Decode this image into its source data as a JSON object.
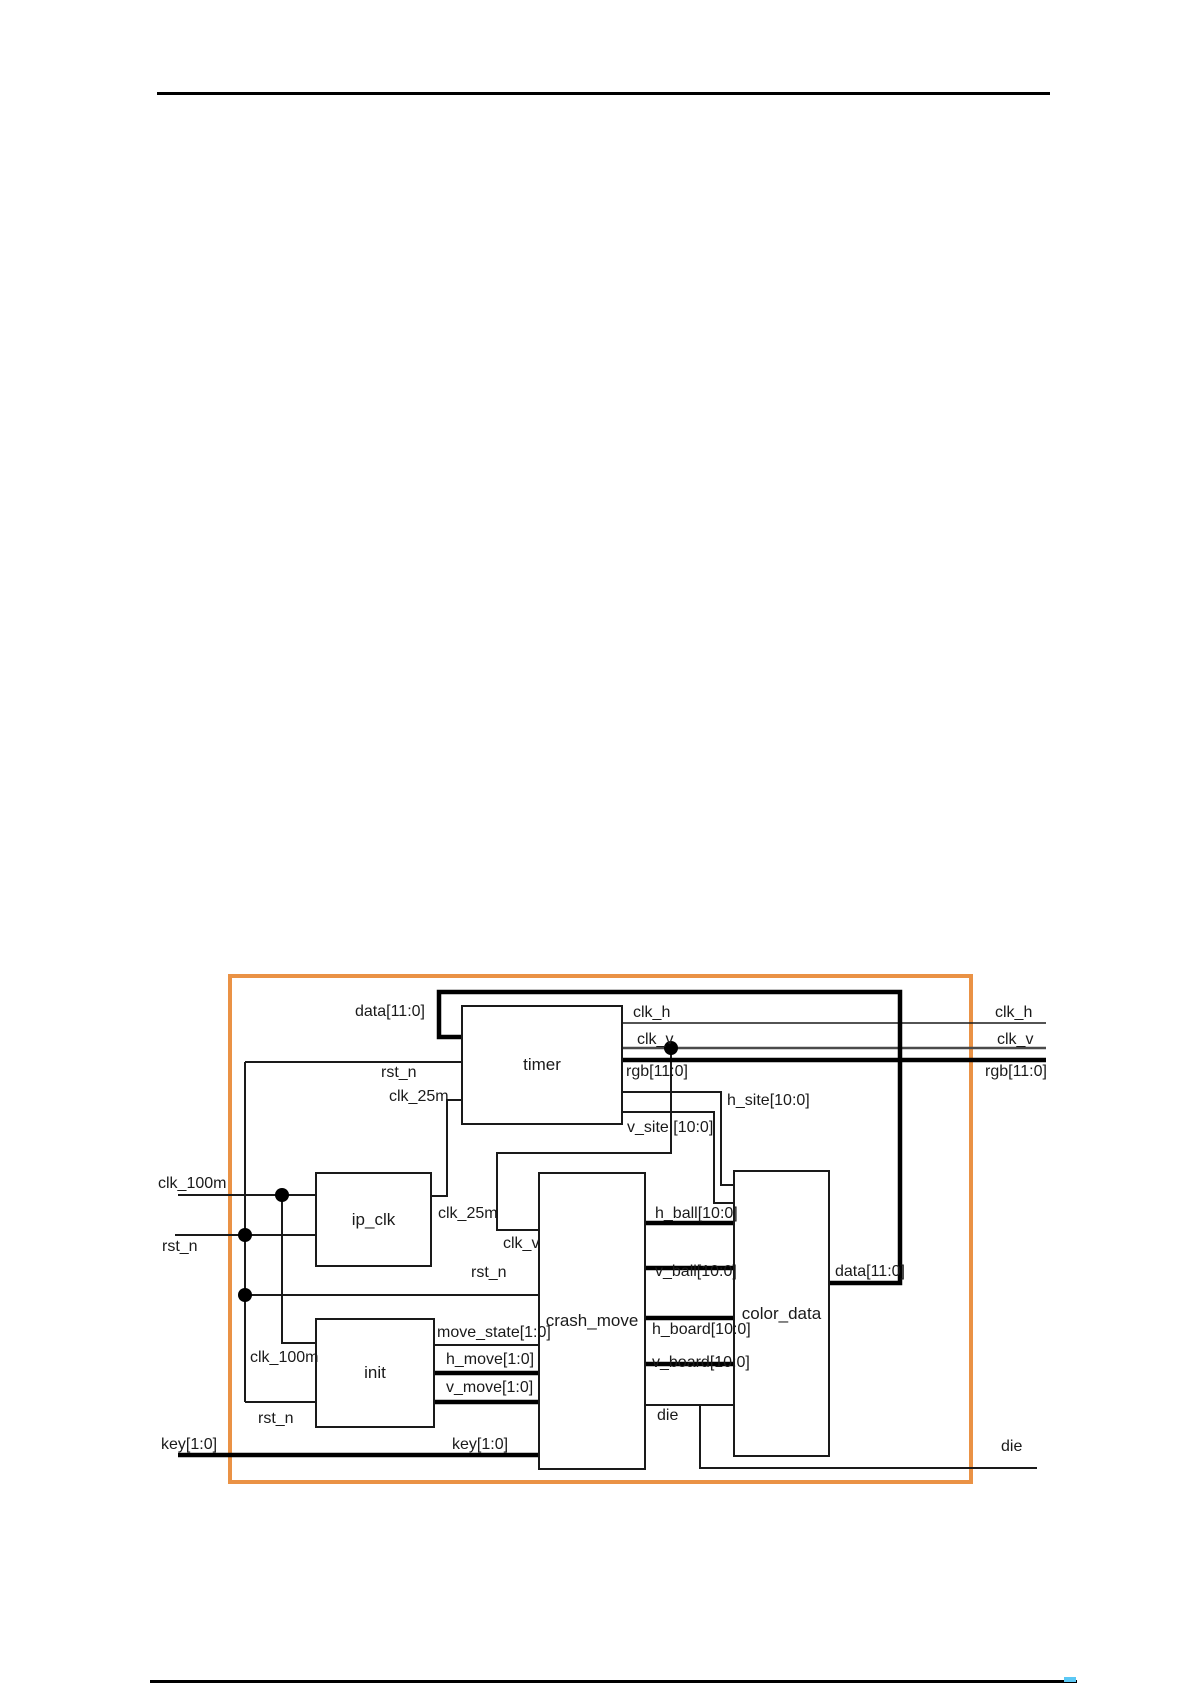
{
  "page": {
    "width": 1192,
    "height": 1685,
    "background": "#ffffff",
    "top_rule": {
      "x1": 157,
      "x2": 1050,
      "y": 92,
      "thickness": 3,
      "color": "#000000"
    },
    "bottom_rule": {
      "x1": 150,
      "x2": 1077,
      "y": 1680,
      "thickness": 3,
      "color": "#000000"
    },
    "bottom_artifact": {
      "x": 1064,
      "y": 1677,
      "w": 12,
      "h": 5,
      "color": "#5bc8f5"
    }
  },
  "diagram": {
    "title": "FPGA top-level block diagram",
    "frame": {
      "x": 230,
      "y": 976,
      "w": 741,
      "h": 506,
      "color": "#EA9245",
      "thickness": 4
    },
    "wire_color": "#1a1a1a",
    "blocks": [
      {
        "id": "timer",
        "label": "timer",
        "x": 461,
        "y": 1005,
        "w": 162,
        "h": 120
      },
      {
        "id": "ip_clk",
        "label": "ip_clk",
        "x": 315,
        "y": 1172,
        "w": 117,
        "h": 95
      },
      {
        "id": "init",
        "label": "init",
        "x": 315,
        "y": 1318,
        "w": 120,
        "h": 110
      },
      {
        "id": "crash_move",
        "label": "crash_move",
        "x": 538,
        "y": 1172,
        "w": 108,
        "h": 298
      },
      {
        "id": "color_data",
        "label": "color_data",
        "x": 733,
        "y": 1170,
        "w": 97,
        "h": 287
      }
    ],
    "wires": [
      {
        "name": "clk_h-out",
        "kind": "hair",
        "points": [
          [
            623,
            1023
          ],
          [
            1046,
            1023
          ]
        ]
      },
      {
        "name": "clk_v-out",
        "kind": "mid",
        "points": [
          [
            623,
            1048
          ],
          [
            1046,
            1048
          ]
        ]
      },
      {
        "name": "clk_v-branch",
        "kind": "thin",
        "points": [
          [
            671,
            1048
          ],
          [
            671,
            1153
          ],
          [
            497,
            1153
          ],
          [
            497,
            1230
          ],
          [
            538,
            1230
          ]
        ]
      },
      {
        "name": "h_site-wire",
        "kind": "thin",
        "points": [
          [
            623,
            1092
          ],
          [
            721,
            1092
          ],
          [
            721,
            1185
          ],
          [
            733,
            1185
          ]
        ]
      },
      {
        "name": "v_site-wire",
        "kind": "thin",
        "points": [
          [
            623,
            1112
          ],
          [
            714,
            1112
          ],
          [
            714,
            1203
          ],
          [
            733,
            1203
          ]
        ]
      },
      {
        "name": "rst_n-to-timer",
        "kind": "thin",
        "points": [
          [
            245,
            1062
          ],
          [
            461,
            1062
          ]
        ]
      },
      {
        "name": "rst_n-trunk",
        "kind": "thin",
        "points": [
          [
            245,
            1062
          ],
          [
            245,
            1402
          ]
        ]
      },
      {
        "name": "rst_n-input",
        "kind": "thin",
        "points": [
          [
            175,
            1235
          ],
          [
            315,
            1235
          ]
        ]
      },
      {
        "name": "rst_n-to-crash",
        "kind": "thin",
        "points": [
          [
            245,
            1295
          ],
          [
            538,
            1295
          ]
        ]
      },
      {
        "name": "rst_n-to-init",
        "kind": "thin",
        "points": [
          [
            245,
            1402
          ],
          [
            315,
            1402
          ]
        ]
      },
      {
        "name": "clk_100m-input",
        "kind": "thin",
        "points": [
          [
            178,
            1195
          ],
          [
            315,
            1195
          ]
        ]
      },
      {
        "name": "clk_100m-branch",
        "kind": "thin",
        "points": [
          [
            282,
            1195
          ],
          [
            282,
            1343
          ],
          [
            315,
            1343
          ]
        ]
      },
      {
        "name": "clk_25m-wire",
        "kind": "thin",
        "points": [
          [
            432,
            1196
          ],
          [
            447,
            1196
          ],
          [
            447,
            1100
          ],
          [
            461,
            1100
          ]
        ]
      },
      {
        "name": "move_state-wire",
        "kind": "thin",
        "points": [
          [
            435,
            1345
          ],
          [
            538,
            1345
          ]
        ]
      },
      {
        "name": "die-inner",
        "kind": "thin",
        "points": [
          [
            646,
            1405
          ],
          [
            733,
            1405
          ]
        ]
      },
      {
        "name": "die-output",
        "kind": "thin",
        "points": [
          [
            700,
            1405
          ],
          [
            700,
            1468
          ],
          [
            1037,
            1468
          ]
        ]
      },
      {
        "name": "rgb-out",
        "kind": "thick",
        "points": [
          [
            623,
            1060
          ],
          [
            1046,
            1060
          ]
        ]
      },
      {
        "name": "data-feedback",
        "kind": "thick",
        "points": [
          [
            830,
            1283
          ],
          [
            900,
            1283
          ],
          [
            900,
            992
          ],
          [
            439,
            992
          ],
          [
            439,
            1037
          ],
          [
            461,
            1037
          ]
        ]
      },
      {
        "name": "h_move-wire",
        "kind": "thick",
        "points": [
          [
            435,
            1373
          ],
          [
            538,
            1373
          ]
        ]
      },
      {
        "name": "v_move-wire",
        "kind": "thick",
        "points": [
          [
            435,
            1402
          ],
          [
            538,
            1402
          ]
        ]
      },
      {
        "name": "key-input",
        "kind": "thick",
        "points": [
          [
            178,
            1455
          ],
          [
            538,
            1455
          ]
        ]
      },
      {
        "name": "h_ball-wire",
        "kind": "thick",
        "points": [
          [
            646,
            1223
          ],
          [
            733,
            1223
          ]
        ]
      },
      {
        "name": "v_ball-wire",
        "kind": "thick",
        "points": [
          [
            646,
            1268
          ],
          [
            733,
            1268
          ]
        ]
      },
      {
        "name": "h_board-wire",
        "kind": "thick",
        "points": [
          [
            646,
            1318
          ],
          [
            733,
            1318
          ]
        ]
      },
      {
        "name": "v_board-wire",
        "kind": "thick",
        "points": [
          [
            646,
            1364
          ],
          [
            733,
            1364
          ]
        ]
      }
    ],
    "junctions": [
      {
        "x": 671,
        "y": 1048
      },
      {
        "x": 282,
        "y": 1195
      },
      {
        "x": 245,
        "y": 1235
      },
      {
        "x": 245,
        "y": 1295
      }
    ],
    "labels": [
      {
        "name": "data-label-timer",
        "text": "data[11:0]",
        "x": 355,
        "y": 1003
      },
      {
        "name": "rst_n-label-timer",
        "text": "rst_n",
        "x": 381,
        "y": 1064
      },
      {
        "name": "clk_25m-label-timer",
        "text": "clk_25m",
        "x": 389,
        "y": 1088
      },
      {
        "name": "clk_h-label-in",
        "text": "clk_h",
        "x": 633,
        "y": 1004
      },
      {
        "name": "clk_v-label-in",
        "text": "clk_v",
        "x": 637,
        "y": 1031
      },
      {
        "name": "rgb-label-in",
        "text": "rgb[11:0]",
        "x": 626,
        "y": 1063
      },
      {
        "name": "h_site-label",
        "text": "h_site[10:0]",
        "x": 727,
        "y": 1092
      },
      {
        "name": "v_site-label",
        "text": "v_site [10:0]",
        "x": 627,
        "y": 1119
      },
      {
        "name": "clk_h-label-out",
        "text": "clk_h",
        "x": 995,
        "y": 1004
      },
      {
        "name": "clk_v-label-out",
        "text": "clk_v",
        "x": 997,
        "y": 1031
      },
      {
        "name": "rgb-label-out",
        "text": "rgb[11:0]",
        "x": 985,
        "y": 1063
      },
      {
        "name": "clk_100m-label-in",
        "text": "clk_100m",
        "x": 158,
        "y": 1175
      },
      {
        "name": "rst_n-label-in",
        "text": "rst_n",
        "x": 162,
        "y": 1238
      },
      {
        "name": "clk_25m-label-ipclk",
        "text": "clk_25m",
        "x": 438,
        "y": 1205
      },
      {
        "name": "clk_v-label-crash",
        "text": "clk_v",
        "x": 503,
        "y": 1235
      },
      {
        "name": "rst_n-label-crash",
        "text": "rst_n",
        "x": 471,
        "y": 1264
      },
      {
        "name": "clk_100m-label-init",
        "text": "clk_100m",
        "x": 250,
        "y": 1349
      },
      {
        "name": "move_state-label",
        "text": "move_state[1:0]",
        "x": 437,
        "y": 1324
      },
      {
        "name": "h_move-label",
        "text": "h_move[1:0]",
        "x": 446,
        "y": 1351
      },
      {
        "name": "v_move-label",
        "text": "v_move[1:0]",
        "x": 446,
        "y": 1379
      },
      {
        "name": "rst_n-label-init",
        "text": "rst_n",
        "x": 258,
        "y": 1410
      },
      {
        "name": "key-label-in",
        "text": "key[1:0]",
        "x": 161,
        "y": 1436
      },
      {
        "name": "key-label-crash",
        "text": "key[1:0]",
        "x": 452,
        "y": 1436
      },
      {
        "name": "h_ball-label",
        "text": "h_ball[10:0]",
        "x": 655,
        "y": 1205
      },
      {
        "name": "v_ball-label",
        "text": "v_ball[10:0]",
        "x": 655,
        "y": 1263
      },
      {
        "name": "h_board-label",
        "text": "h_board[10:0]",
        "x": 652,
        "y": 1321
      },
      {
        "name": "v_board-label",
        "text": "v_board[10:0]",
        "x": 652,
        "y": 1354
      },
      {
        "name": "die-label-inner",
        "text": "die",
        "x": 657,
        "y": 1407
      },
      {
        "name": "data-label-colordata",
        "text": "data[11:0]",
        "x": 835,
        "y": 1263
      },
      {
        "name": "die-label-out",
        "text": "die",
        "x": 1001,
        "y": 1438
      }
    ]
  }
}
